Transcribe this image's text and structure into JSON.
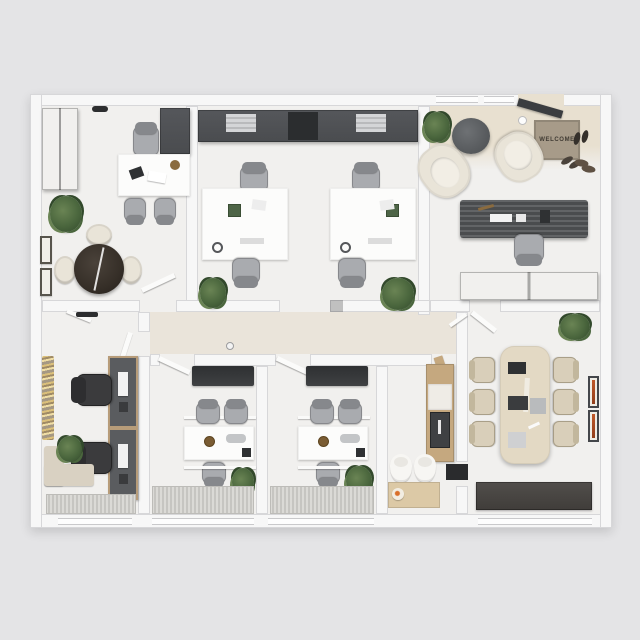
{
  "scene_description": "Top-down 3D architectural render of an office suite floor plan",
  "entry": {
    "welcome_mat_text": "WELCOME"
  },
  "palette": {
    "bg": "#e4e4e6",
    "wall": "#f7f7f7",
    "wall_edge": "#d7d7d9",
    "floor": "#f1f0ee",
    "floor_warm": "#e8e0d0",
    "corridor": "#ece6da",
    "dark": "#4a4c4f",
    "darker": "#313335",
    "wood": "#c5a87f",
    "wood_light": "#dcc9a6",
    "cream": "#e9e4d8",
    "tan": "#d9cfba",
    "tan_edge": "#a99f88",
    "chair": "#86888c",
    "chair_seat": "#a9abaf",
    "black_chair": "#2e2e30",
    "plant": "#4a663d",
    "plant_d": "#32492b",
    "plant_l": "#6a8454",
    "table_brown": "#362f28",
    "mat": "#a79b89",
    "mat_text": "#403b33",
    "orange": "#c35a2a",
    "gold": "#c2a050",
    "grate_a": "#dbdad6",
    "grate_b": "#c6c5c1"
  },
  "rooms": [
    {
      "name": "private-office-top-left",
      "furniture": [
        "tall wardrobe cabinet",
        "corner cabinet",
        "white executive desk",
        "desk chair",
        "2 guest chairs",
        "round dark table",
        "3 cream chairs",
        "plant",
        "2 wall pictures",
        "ceiling light"
      ]
    },
    {
      "name": "open-office-top-center",
      "furniture": [
        "dark wall cabinet row",
        "2 white desk clusters",
        "4 gray task chairs",
        "2 plants"
      ]
    },
    {
      "name": "reception-entry",
      "furniture": [
        "entry door",
        "welcome mat",
        "3 pairs of shoes",
        "2 cream lounge armchairs",
        "round coffee table",
        "plant",
        "ribbed reception counter",
        "task chair",
        "dark credenza",
        "pendant light"
      ]
    },
    {
      "name": "workstation-room-bottom-left",
      "furniture": [
        "2 wall-mounted workstations with monitors",
        "2 black task chairs",
        "gold wall art",
        "corner bench",
        "plant",
        "floor grate",
        "ceiling light"
      ]
    },
    {
      "name": "small-meeting-room-1",
      "furniture": [
        "wall tv",
        "white desk",
        "2 chairs + 1 chair",
        "desk accessories",
        "plant",
        "floor grate"
      ]
    },
    {
      "name": "small-meeting-room-2",
      "furniture": [
        "wall tv",
        "white desk",
        "2 chairs + 1 chair",
        "desk accessories",
        "plant",
        "floor grate"
      ]
    },
    {
      "name": "wc-kitchenette",
      "furniture": [
        "wood cabinet with sink",
        "2 toilets",
        "wood counter with food plate",
        "wood door"
      ]
    },
    {
      "name": "conference-room",
      "furniture": [
        "beige conference table",
        "6 tan chairs",
        "plant",
        "2 orange artworks",
        "dark sideboard",
        "dark door mat"
      ]
    }
  ]
}
